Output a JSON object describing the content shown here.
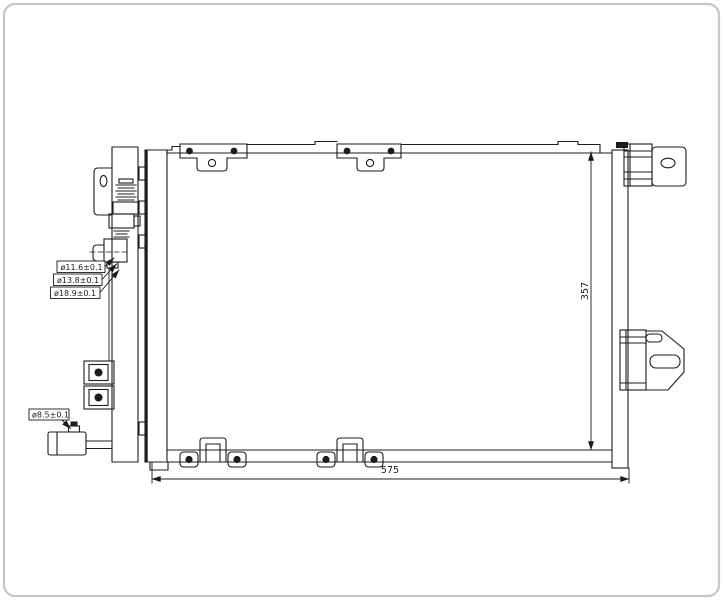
{
  "drawing": {
    "port_labels": {
      "small": "ø11.6±0.1",
      "medium": "ø13.8±0.1",
      "large": "ø18.9±0.1",
      "drier": "ø8.5±0.1"
    },
    "dimensions": {
      "height": "357",
      "width": "575"
    },
    "colors": {
      "line": "#1c1c1c",
      "background": "#ffffff",
      "frame_border": "#c6c6c6"
    }
  }
}
